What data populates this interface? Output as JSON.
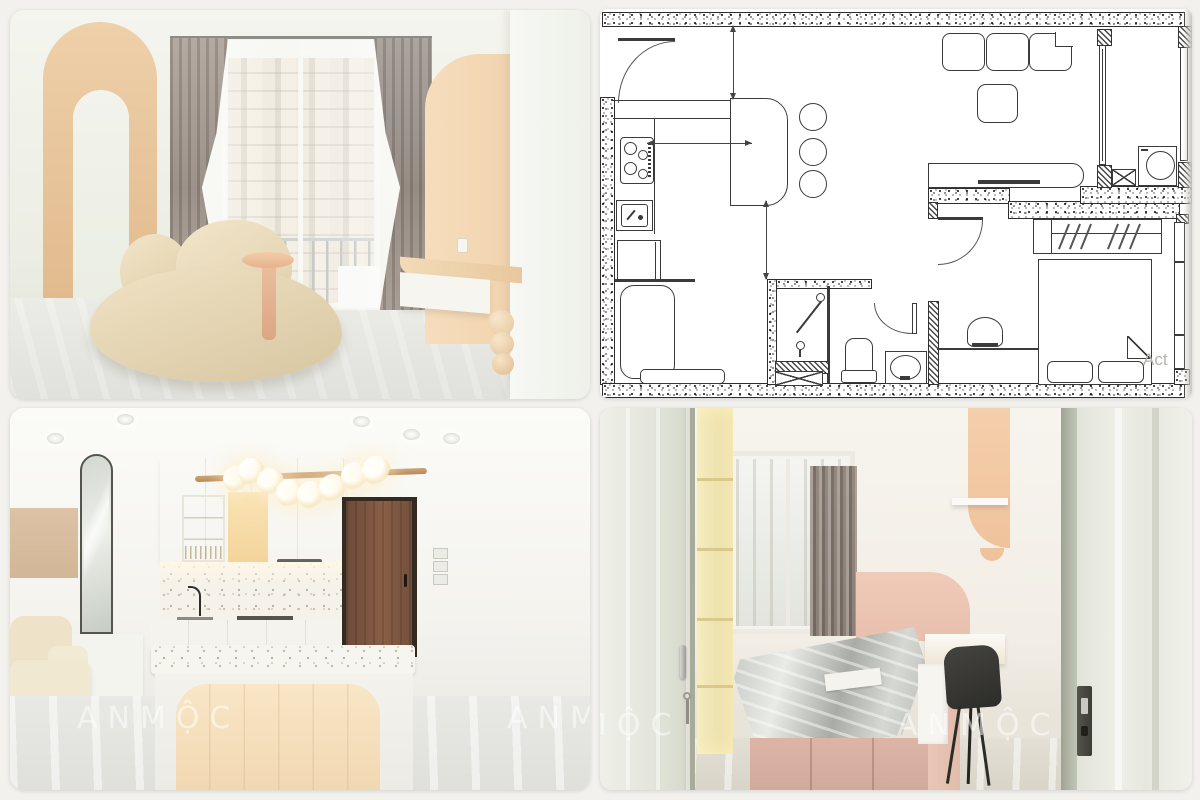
{
  "meta": {
    "title": "Apartment interior design collage with floor plan",
    "panel_count": 4
  },
  "watermark": {
    "brand": "ANMỘC",
    "plan_corner_text": "Act"
  },
  "panels": {
    "living_room": {
      "label": "living-room-photo",
      "description": "Living room with tan arched accent wall, curved cream sofa, taupe curtains, balcony door and floating console with sphere leg"
    },
    "floor_plan": {
      "label": "floor-plan-drawing",
      "description": "Black-and-white apartment floor plan with stippled walls",
      "rooms": [
        "kitchen",
        "living-dining",
        "balcony",
        "bathroom",
        "wc",
        "bedroom"
      ],
      "symbols": [
        "entry-door-swing",
        "kitchen-counter",
        "cooktop-4-burner",
        "kitchen-sink",
        "island-counter",
        "bar-stools-3",
        "dining-table",
        "bench",
        "sofa-3-seat",
        "coffee-table",
        "tv-console",
        "washing-machine",
        "shaft-x-box",
        "shower",
        "vanity-basin",
        "toilet",
        "wardrobe-with-hangers",
        "double-bed-2-pillows",
        "folded-blanket-corner",
        "desk",
        "desk-chair",
        "window-strips",
        "dimension-arrows"
      ]
    },
    "kitchen": {
      "label": "kitchen-photo",
      "description": "White kitchen with terrazzo island and backsplash, wood bar pendant with glass globes, wooden entry door, arched mirror and cream sofa"
    },
    "bedroom": {
      "label": "bedroom-photo",
      "description": "Bedroom seen through an open door: pink platform bed with plastic-wrapped mattress, grey curtain, peach arch wall, white desk with black chair"
    }
  },
  "colors": {
    "page_background": "#f2f1ee",
    "accent_tan": "#e6c39c",
    "accent_peach": "#f4d9ba",
    "sofa_cream": "#e9dcbd",
    "curtain_taupe": "#a2978f",
    "bed_pink": "#d6afa2",
    "door_wood": "#7a5640",
    "plan_line": "#3b3b3b",
    "plan_note_gray": "#b6b4af",
    "watermark_white": "rgba(255,255,255,0.52)"
  }
}
